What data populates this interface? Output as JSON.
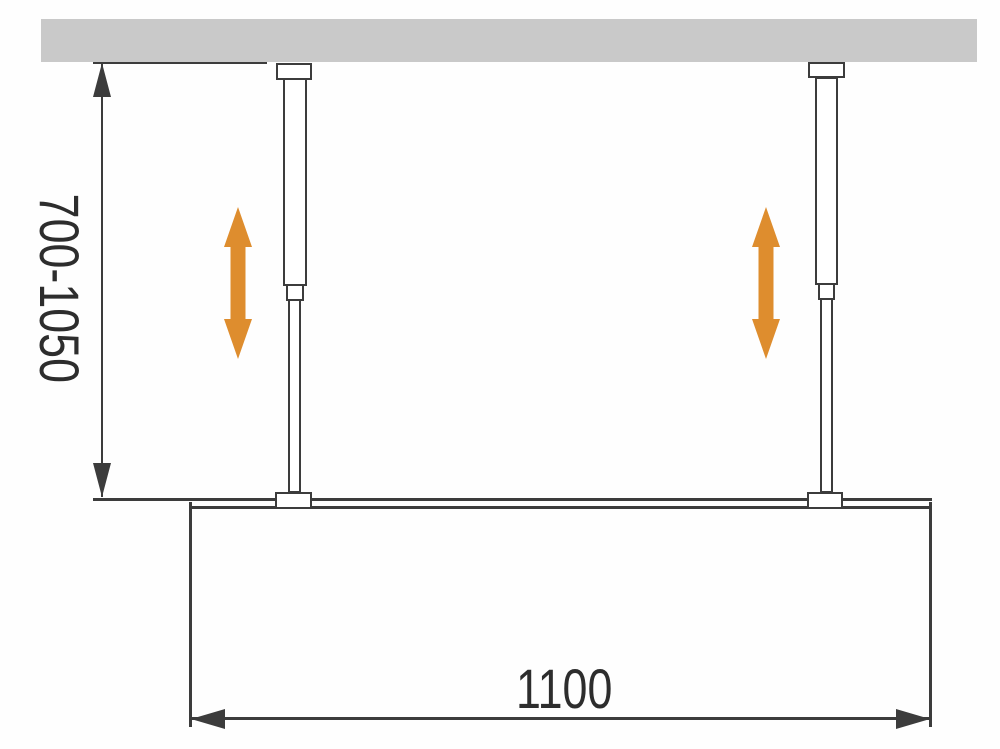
{
  "diagram": {
    "dimensions": {
      "height_range_label": "700-1050",
      "width_label": "1100"
    },
    "colors": {
      "wall": "#C9C9C9",
      "line": "#3C3C3C",
      "text": "#2D2D2D",
      "accent_orange": "#DE8D2E",
      "fixture_fill": "#FFFFFF"
    },
    "icons": {
      "height_adjust_arrow": "double-vertical-arrow"
    }
  }
}
